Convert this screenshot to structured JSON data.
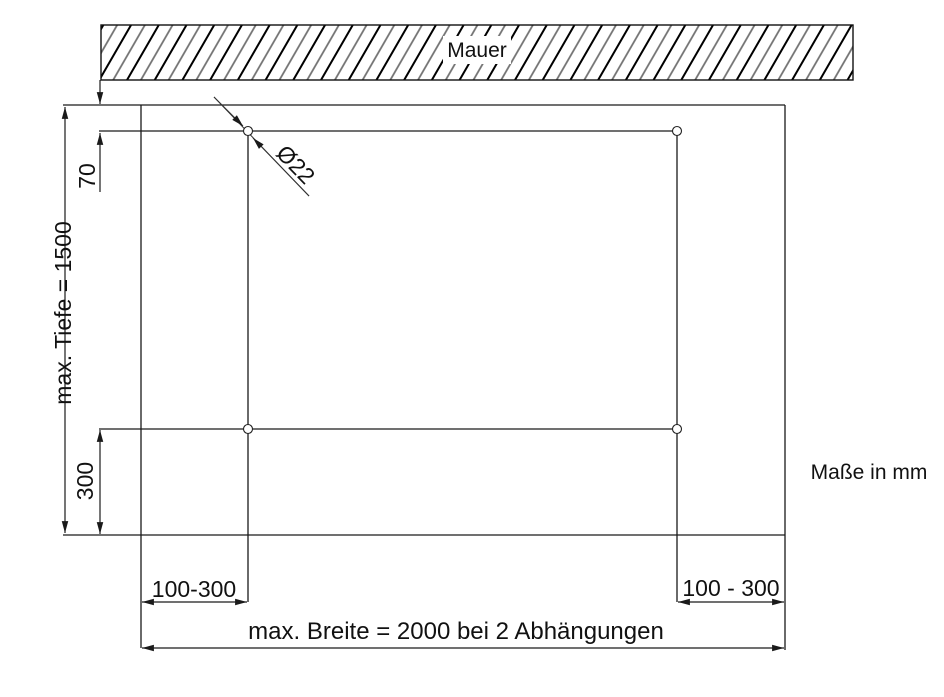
{
  "diagram": {
    "wall": {
      "label": "Mauer"
    },
    "note": {
      "units": "Maße in mm"
    },
    "dimensions": {
      "depth": "max. Tiefe = 1500",
      "suspension_top_offset": "70",
      "suspension_bottom_offset": "300",
      "suspension_left_spacing": "100-300",
      "suspension_right_spacing": "100 - 300",
      "max_width": "max. Breite = 2000 bei 2 Abhängungen",
      "hole_diameter": "Ø22"
    },
    "colors": {
      "line": "#1a1a1a",
      "hatch_dark": "#000000",
      "hatch_mid": "#707070",
      "text": "#111111",
      "background": "#ffffff"
    }
  }
}
